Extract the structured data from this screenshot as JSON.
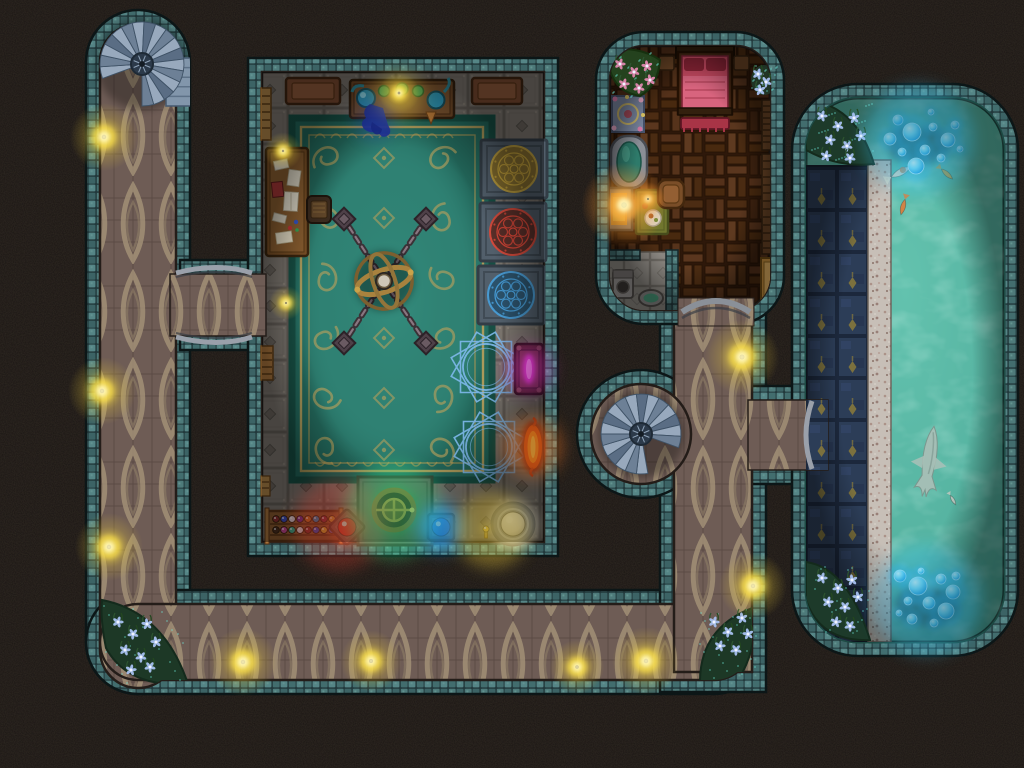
{
  "map": {
    "background": "#15110f",
    "kind": "fantasy-dungeon-battle-map",
    "grid_visible": true
  },
  "palette": {
    "wall_teal": "#46716f",
    "wall_dark": "#22393c",
    "corridor_floor": "#6e5c55",
    "corridor_tracery": "#a59478",
    "room_floor": "#7c766f",
    "carpet": "#2f8173",
    "carpet_gold": "#c2a25a",
    "wood_floor": "#48290f",
    "water": "#58b6a3",
    "walkway_navy": "#2c3d57",
    "ledge_stone": "#c7bfb7",
    "torch_glow": "#ffd94a",
    "magic_blue": "#7fb9ec",
    "bubble_blue": "#2fa8e8",
    "stair_stone": "#98a9bd"
  },
  "regions": [
    {
      "name": "west-corridor"
    },
    {
      "name": "south-corridor"
    },
    {
      "name": "east-corridor"
    },
    {
      "name": "arcane-workshop"
    },
    {
      "name": "bedchamber"
    },
    {
      "name": "bathing-nook"
    },
    {
      "name": "pool-hall"
    },
    {
      "name": "pool-walkway"
    },
    {
      "name": "workshop-bridge"
    },
    {
      "name": "stair-alcove"
    },
    {
      "name": "pool-entrance"
    }
  ],
  "furniture": [
    "alchemy-bench",
    "wooden-benches",
    "reading-desk",
    "reading-chair",
    "wall-ladders",
    "great-carpet",
    "armillary-sphere",
    "chain-anchors",
    "rune-pedestals",
    "summoning-circles",
    "arcane-altar",
    "fire-portal",
    "ritual-platform",
    "potion-rack",
    "canopy-bed",
    "night-stands",
    "bed-bench",
    "bath-tub",
    "hearth",
    "writing-table",
    "armchair",
    "meal-plate",
    "privy",
    "wash-basin",
    "bookshelves",
    "gilded-bench",
    "garden-planter",
    "mosaic-tile"
  ],
  "lights": [
    {
      "x": 104,
      "y": 137,
      "s": 1
    },
    {
      "x": 102,
      "y": 391,
      "s": 1
    },
    {
      "x": 109,
      "y": 547,
      "s": 1
    },
    {
      "x": 243,
      "y": 662,
      "s": 1
    },
    {
      "x": 371,
      "y": 661,
      "s": 0.9
    },
    {
      "x": 577,
      "y": 667,
      "s": 0.8
    },
    {
      "x": 646,
      "y": 661,
      "s": 1
    },
    {
      "x": 753,
      "y": 586,
      "s": 1
    },
    {
      "x": 742,
      "y": 357,
      "s": 1.1
    },
    {
      "x": 283,
      "y": 151,
      "s": 0.55
    },
    {
      "x": 399,
      "y": 93,
      "s": 0.6
    },
    {
      "x": 286,
      "y": 303,
      "s": 0.5
    },
    {
      "x": 624,
      "y": 205,
      "s": 1.25,
      "g": "o"
    },
    {
      "x": 648,
      "y": 199,
      "s": 0.5,
      "g": "o"
    }
  ],
  "light_washes": [
    {
      "x": 340,
      "y": 524,
      "r": 46,
      "c": "#ff4530",
      "o": 0.26
    },
    {
      "x": 394,
      "y": 511,
      "r": 48,
      "c": "#3dff8e",
      "o": 0.3
    },
    {
      "x": 441,
      "y": 527,
      "r": 26,
      "c": "#2fa8ff",
      "o": 0.4
    },
    {
      "x": 492,
      "y": 530,
      "r": 38,
      "c": "#ffd83a",
      "o": 0.35
    },
    {
      "x": 533,
      "y": 447,
      "r": 30,
      "c": "#ff7a20",
      "o": 0.4
    },
    {
      "x": 529,
      "y": 369,
      "r": 24,
      "c": "#e838d8",
      "o": 0.33
    },
    {
      "x": 399,
      "y": 96,
      "r": 24,
      "c": "#ffe44a",
      "o": 0.3
    },
    {
      "x": 375,
      "y": 120,
      "r": 20,
      "c": "#2848c8",
      "o": 0.25
    },
    {
      "x": 918,
      "y": 140,
      "r": 55,
      "c": "#35c8ff",
      "o": 0.3
    },
    {
      "x": 926,
      "y": 600,
      "r": 55,
      "c": "#35c8ff",
      "o": 0.3
    }
  ],
  "stairs": [
    {
      "name": "northwest-spiral-stair",
      "cx": 142,
      "cy": 64,
      "r": 42,
      "start": 160,
      "sweep": 290,
      "steps": 18,
      "tail": [
        166,
        58,
        26,
        48
      ]
    },
    {
      "name": "central-spiral-stair",
      "cx": 641,
      "cy": 434,
      "r": 40,
      "start": 80,
      "sweep": 300,
      "steps": 18
    }
  ],
  "magic_circles": {
    "color": "#7fb9ec",
    "items": [
      {
        "cx": 486,
        "cy": 367,
        "r": 36
      },
      {
        "cx": 489,
        "cy": 447,
        "r": 36
      }
    ]
  },
  "rune_pedestals": [
    {
      "cx": 514,
      "cy": 169,
      "c": "#c9a63c",
      "fill": "#8a6f28",
      "name": "gold-rune-pedestal"
    },
    {
      "cx": 513,
      "cy": 232,
      "c": "#e04838",
      "fill": "#5a2a22",
      "name": "red-rune-pedestal"
    },
    {
      "cx": 511,
      "cy": 295,
      "c": "#48a0dc",
      "fill": "#27506a",
      "name": "blue-rune-pedestal"
    }
  ],
  "artifact": {
    "name": "chained-armillary-sphere",
    "cx": 384,
    "cy": 281,
    "anchors": [
      [
        344,
        219
      ],
      [
        426,
        219
      ],
      [
        344,
        343
      ],
      [
        426,
        343
      ]
    ]
  },
  "potion_rack": {
    "name": "potion-rack",
    "box": [
      267,
      511,
      74,
      30
    ],
    "rows": [
      [
        "#8a2e2e",
        "#3a4ec0",
        "#d8d8e0",
        "#70309a",
        "#c87020",
        "#2e8ac0",
        "#902e40",
        "#d8b030"
      ],
      [
        "#4a2e1e",
        "#c04890",
        "#30b090",
        "#e0e0e6",
        "#8a2e2e",
        "#3a4ec0",
        "#d8b030",
        "#5a6ac8"
      ]
    ]
  },
  "orbs": [
    {
      "cx": 347,
      "cy": 527,
      "r": 9,
      "c": "#ff3a28",
      "glow": "#ff6a40",
      "stand": "square",
      "name": "red-orb"
    },
    {
      "cx": 441,
      "cy": 527,
      "r": 9,
      "c": "#2f8aff",
      "glow": "#48b0ff",
      "stand": "diamond",
      "name": "blue-orb"
    },
    {
      "cx": 513,
      "cy": 524,
      "r": 12,
      "c": "#efece2",
      "glow": "#ffffff",
      "stand": "pedestal",
      "name": "white-orb"
    },
    {
      "cx": 486,
      "cy": 529,
      "r": 3,
      "c": "#ffd84a",
      "glow": "#ffe87a",
      "stand": "candle",
      "name": "golden-candlestick"
    }
  ],
  "pool": {
    "fish": [
      {
        "x": 901,
        "y": 172,
        "a": -28,
        "t": "koi",
        "c": "#ded6c4",
        "len": 22,
        "name": "white-koi"
      },
      {
        "x": 947,
        "y": 174,
        "a": 42,
        "t": "fish",
        "c": "#c9a94e",
        "len": 15,
        "name": "gold-fish"
      },
      {
        "x": 903,
        "y": 207,
        "a": 105,
        "t": "fish",
        "c": "#d97f3e",
        "len": 16,
        "name": "orange-fish"
      },
      {
        "x": 929,
        "y": 462,
        "a": 8,
        "t": "shark",
        "c": "#aabfb7",
        "len": 72,
        "name": "shark"
      },
      {
        "x": 953,
        "y": 500,
        "a": 60,
        "t": "fish",
        "c": "#b9c5bd",
        "len": 11,
        "name": "small-fish"
      }
    ],
    "bubble_clusters": [
      {
        "glow": [
          918,
          138
        ],
        "items": [
          [
            898,
            120,
            5
          ],
          [
            912,
            132,
            9
          ],
          [
            933,
            127,
            4
          ],
          [
            948,
            140,
            7
          ],
          [
            902,
            152,
            4
          ],
          [
            925,
            150,
            5
          ],
          [
            941,
            158,
            4
          ],
          [
            916,
            166,
            8
          ],
          [
            955,
            125,
            4
          ],
          [
            890,
            139,
            6
          ],
          [
            960,
            149,
            3
          ],
          [
            931,
            112,
            3
          ]
        ]
      },
      {
        "glow": [
          926,
          600
        ],
        "items": [
          [
            900,
            576,
            6
          ],
          [
            918,
            586,
            9
          ],
          [
            941,
            579,
            5
          ],
          [
            953,
            592,
            7
          ],
          [
            908,
            601,
            4
          ],
          [
            929,
            603,
            6
          ],
          [
            946,
            611,
            8
          ],
          [
            912,
            619,
            5
          ],
          [
            934,
            623,
            4
          ],
          [
            956,
            576,
            4
          ],
          [
            899,
            613,
            3
          ],
          [
            921,
            571,
            3
          ]
        ]
      }
    ]
  },
  "flower_beds": [
    {
      "name": "corridor-southwest-bed",
      "box": [
        104,
        606,
        82,
        78
      ],
      "flowers": [
        [
          118,
          622
        ],
        [
          133,
          634
        ],
        [
          147,
          624
        ],
        [
          125,
          650
        ],
        [
          141,
          657
        ],
        [
          156,
          642
        ],
        [
          131,
          670
        ],
        [
          150,
          667
        ]
      ]
    },
    {
      "name": "corridor-southeast-bed",
      "box": [
        700,
        608,
        60,
        72
      ],
      "flowers": [
        [
          714,
          622
        ],
        [
          728,
          632
        ],
        [
          742,
          618
        ],
        [
          720,
          646
        ],
        [
          736,
          650
        ],
        [
          748,
          634
        ]
      ]
    },
    {
      "name": "pool-north-bed",
      "box": [
        810,
        102,
        64,
        62
      ],
      "flowers": [
        [
          822,
          116
        ],
        [
          838,
          126
        ],
        [
          854,
          118
        ],
        [
          830,
          140
        ],
        [
          847,
          146
        ],
        [
          861,
          136
        ],
        [
          826,
          156
        ],
        [
          850,
          158
        ]
      ]
    },
    {
      "name": "pool-south-bed",
      "box": [
        812,
        564,
        58,
        74
      ],
      "flowers": [
        [
          822,
          578
        ],
        [
          838,
          588
        ],
        [
          852,
          580
        ],
        [
          828,
          602
        ],
        [
          845,
          607
        ],
        [
          858,
          597
        ],
        [
          836,
          622
        ],
        [
          850,
          626
        ]
      ]
    },
    {
      "name": "bedroom-garden-bed",
      "box": [
        612,
        52,
        48,
        46
      ],
      "petal": "#e088b0",
      "flowers": [
        [
          620,
          64
        ],
        [
          634,
          72
        ],
        [
          647,
          66
        ],
        [
          624,
          84
        ],
        [
          639,
          88
        ],
        [
          650,
          80
        ]
      ]
    },
    {
      "name": "bedroom-corner-flowers",
      "box": [
        752,
        66,
        26,
        28
      ],
      "flowers": [
        [
          758,
          74
        ],
        [
          766,
          82
        ],
        [
          760,
          90
        ]
      ]
    }
  ]
}
